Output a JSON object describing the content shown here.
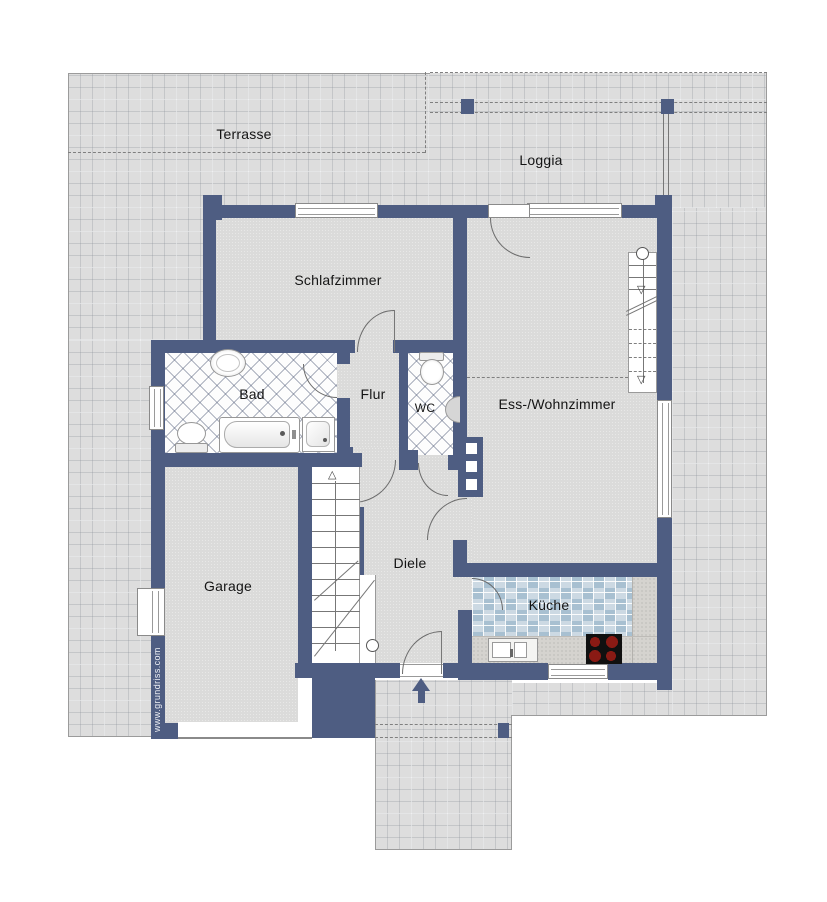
{
  "plan": {
    "rooms": {
      "terrasse": "Terrasse",
      "loggia": "Loggia",
      "schlafzimmer": "Schlafzimmer",
      "bad": "Bad",
      "flur": "Flur",
      "wc": "WC",
      "ess_wohnzimmer": "Ess-/Wohnzimmer",
      "garage": "Garage",
      "diele": "Diele",
      "kueche": "Küche"
    },
    "watermark": "www.grundriss.com",
    "colors": {
      "wall": "#4e5d82",
      "floor": "#dbdbda",
      "terrace_tile": "#dddddd",
      "kitchen_tile_dark": "#a8c0d1",
      "kitchen_tile_light": "#ccd9e3",
      "stove": "#101010",
      "burner": "#8a1a14"
    }
  }
}
